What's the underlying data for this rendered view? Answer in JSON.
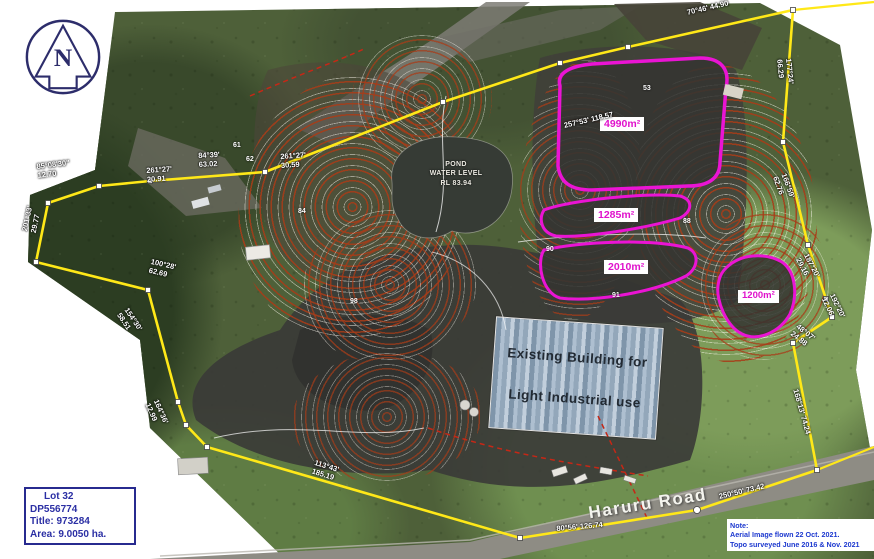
{
  "north_label": "N",
  "parcel_box": {
    "lines": [
      "Lot 32",
      "DP556774",
      "Title: 973284",
      "Area: 9.0050 ha."
    ]
  },
  "note_box": {
    "lines": [
      "Note:",
      "Aerial Image flown 22 Oct. 2021.",
      "Topo surveyed June 2016 & Nov. 2021"
    ]
  },
  "road_label": "Haruru Road",
  "pond_label": {
    "lines": [
      "POND",
      "WATER LEVEL",
      "RL 83.94"
    ]
  },
  "building_label": {
    "lines": [
      "Existing Building for",
      "Light Industrial use"
    ]
  },
  "areas": [
    {
      "id": "area-4990",
      "label": "4990m²"
    },
    {
      "id": "area-1285",
      "label": "1285m²"
    },
    {
      "id": "area-2010",
      "label": "2010m²"
    },
    {
      "id": "area-1200",
      "label": "1200m²"
    }
  ],
  "survey_labels": [
    "85°08'30\"\n12.70",
    "261°27'\n20.91",
    "261°27'\n30.59",
    "84°39'\n63.02",
    "201°33'\n29.77",
    "100°28'\n62.69",
    "154°30'\n58.51",
    "164°36'\n12.99",
    "113°43'\n185.19",
    "80°56'  126.74",
    "250°50'  73.42",
    "168°13'  74.24",
    "48°07'\n24.88",
    "192°20'\n12.06",
    "187°20'\n29.16",
    "166°59'\n62.76",
    "177°24'\n66.29",
    "257°53'  118.57",
    "70°46'  44.90"
  ],
  "spot_elevations": [
    "61",
    "62",
    "53",
    "88",
    "90",
    "91",
    "84",
    "98"
  ],
  "colors": {
    "boundary_yellow": "#ffe818",
    "area_magenta": "#ea14d4",
    "contour_red": "#a83c18",
    "annotation_blue": "#2b2fa4",
    "note_blue": "#1d39cf"
  }
}
